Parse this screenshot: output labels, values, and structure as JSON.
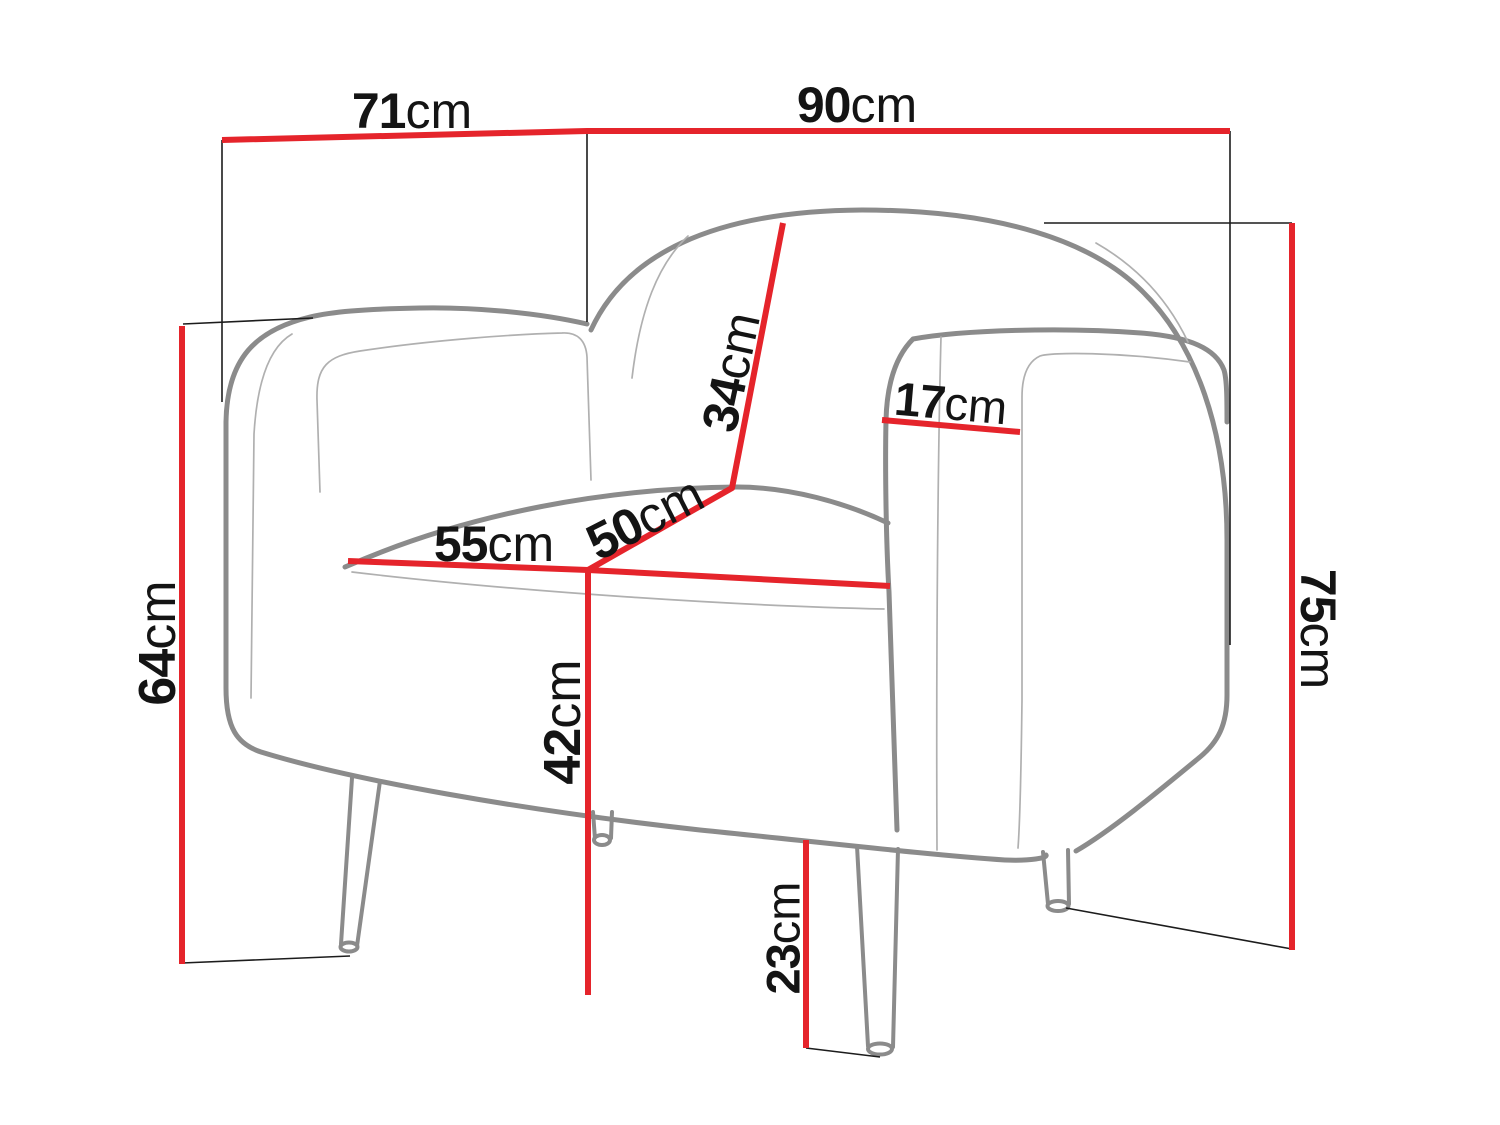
{
  "diagram": {
    "type": "furniture-dimension-diagram",
    "subject": "armchair line drawing with measurement callouts",
    "unit": "cm",
    "colors": {
      "dimension_line": "#e5242b",
      "outline": "#8b8b8b",
      "inner_line": "#b0b0b0",
      "guide_line": "#1c1c1c",
      "text": "#141414",
      "background": "#ffffff"
    },
    "dimensions": [
      {
        "id": "top-depth",
        "value": "71",
        "unit": "cm"
      },
      {
        "id": "top-width",
        "value": "90",
        "unit": "cm"
      },
      {
        "id": "backrest-height",
        "value": "34",
        "unit": "cm"
      },
      {
        "id": "armrest-width",
        "value": "17",
        "unit": "cm"
      },
      {
        "id": "seat-depth",
        "value": "50",
        "unit": "cm"
      },
      {
        "id": "seat-width",
        "value": "55",
        "unit": "cm"
      },
      {
        "id": "side-height",
        "value": "64",
        "unit": "cm"
      },
      {
        "id": "seat-height",
        "value": "42",
        "unit": "cm"
      },
      {
        "id": "overall-height",
        "value": "75",
        "unit": "cm"
      },
      {
        "id": "leg-height",
        "value": "23",
        "unit": "cm"
      }
    ]
  }
}
